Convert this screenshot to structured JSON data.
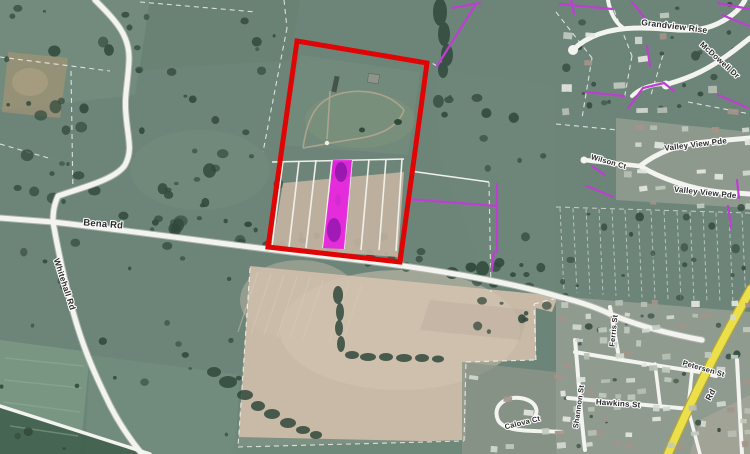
{
  "map": {
    "road_labels": [
      {
        "id": "bena-rd",
        "text": "Bena Rd"
      },
      {
        "id": "whitehall-rd",
        "text": "Whitehall Rd"
      },
      {
        "id": "grandview-rise",
        "text": "Grandview Rise"
      },
      {
        "id": "mcdowell-dr",
        "text": "McDowell Dr"
      },
      {
        "id": "wilson-ct",
        "text": "Wilson Ct"
      },
      {
        "id": "valley-view-pde-upper",
        "text": "Valley View Pde"
      },
      {
        "id": "valley-view-pde-lower",
        "text": "Valley View Pde"
      },
      {
        "id": "ferris-st",
        "text": "Ferris St"
      },
      {
        "id": "petersen-st",
        "text": "Petersen St"
      },
      {
        "id": "shannon-st",
        "text": "Shannon St"
      },
      {
        "id": "hawkins-st",
        "text": "Hawkins St"
      },
      {
        "id": "calova-ct",
        "text": "Calova Ct"
      },
      {
        "id": "highway-rd",
        "text": "Rd"
      }
    ],
    "overlays": {
      "property_boundary_color": "#e00505",
      "highlighted_parcel_color": "#ea1ae2",
      "parcel_line_color": "#bd3fd1",
      "highway_color": "#ece04a",
      "highway_casing_color": "#b3a73c",
      "road_color": "#f3f4ef",
      "road_casing_color": "#b9bdb4"
    },
    "colors": {
      "field_green": "#6d8579",
      "field_green_dark": "#5e7668",
      "paddock_tan": "#c9b9a7",
      "suburb_gray": "#939d92",
      "tree_dark": "#31493b",
      "dashed_boundary": "#ffffff",
      "house_palette": [
        "#e4e7e1",
        "#d3d9d1",
        "#c1cabe",
        "#a5948a",
        "#b8bfb4"
      ]
    }
  }
}
